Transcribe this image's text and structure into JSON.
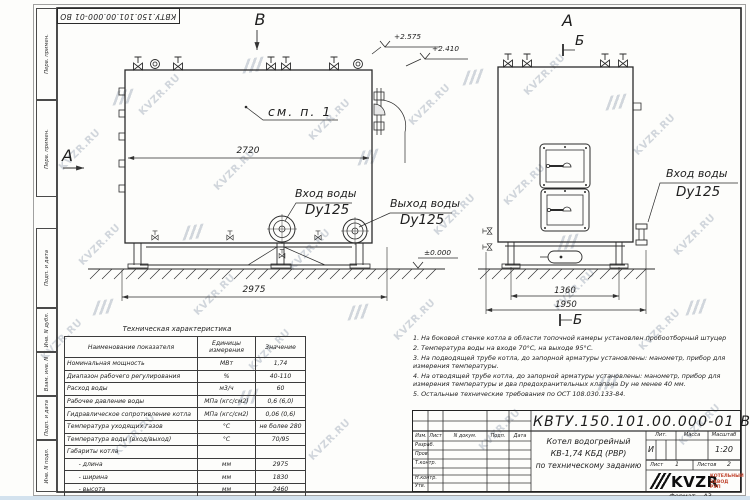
{
  "sheet": {
    "doc_number": "КВТУ.150.101.00.000-01 ВО",
    "format_label": "Формат",
    "format_value": "А3",
    "watermark": "KVZR.RU"
  },
  "margin_labels": [
    "Перв. примен.",
    "Перв. примен.",
    "Подп. и дата",
    "Инв. N дубл.",
    "Взам. инв. N",
    "Подп. и дата",
    "Инв. N подл."
  ],
  "side_view": {
    "view_arrow_top": "В",
    "view_arrow_left": "А",
    "callout": "см. п. 1",
    "elev_top": "+2.575",
    "elev_mid": "+2.410",
    "elev_zero": "±0.000",
    "dim_inner": "2720",
    "dim_outer": "2975",
    "inlet_title": "Вход воды",
    "inlet_dn": "Dy125",
    "outlet_title": "Выход воды",
    "outlet_dn": "Dy125"
  },
  "front_view": {
    "view_title": "А",
    "section_top": "Б",
    "section_bottom": "Б",
    "dim_inner": "1360",
    "dim_outer": "1950",
    "inlet_title": "Вход воды",
    "inlet_dn": "Dy125"
  },
  "spec_table": {
    "title": "Техническая характеристика",
    "headers": [
      "Наименование показателя",
      "Единицы измерения",
      "Значение"
    ],
    "rows": [
      [
        "Номинальная мощность",
        "МВт",
        "1,74"
      ],
      [
        "Диапазон рабочего регулирования",
        "%",
        "40-110"
      ],
      [
        "Расход воды",
        "м3/ч",
        "60"
      ],
      [
        "Рабочее давление воды",
        "МПа (кгс/см2)",
        "0,6 (6,0)"
      ],
      [
        "Гидравлическое сопротивление котла",
        "МПа (кгс/см2)",
        "0,06 (0,6)"
      ],
      [
        "Температура уходящих газов",
        "°С",
        "не более 280"
      ],
      [
        "Температура воды (вход/выход)",
        "°С",
        "70/95"
      ],
      [
        "Габариты котла",
        "",
        ""
      ],
      [
        "      - длина",
        "мм",
        "2975"
      ],
      [
        "      - ширина",
        "мм",
        "1830"
      ],
      [
        "      - высота",
        "мм",
        "2460"
      ]
    ]
  },
  "notes": [
    "1.  На боковой стенке котла в области топочной камеры установлен пробоотборный штуцер",
    "2.  Температура воды на входе 70°С, на выходе 95°С.",
    "3.  На подводящей трубе котла, до запорной арматуры установлены: манометр, прибор для измерения температуры.",
    "4.  На отводящей трубе котла, до запорной арматуры установлены: манометр, прибор для измерения температуры и два предохранительных клапана Dу не менее 40 мм.",
    "5.  Остальные технические требования по ОСТ 108.030.133-84."
  ],
  "title_block": {
    "doc_number": "КВТУ.150.101.00.000-01 ВО",
    "col_izm": "Изм.",
    "col_list": "Лист",
    "col_ndoc": "N докум.",
    "col_podp": "Подп.",
    "col_data": "Дата",
    "row_razrab": "Разраб.",
    "row_prov": "Пров.",
    "row_tkontr": "Т.контр.",
    "row_nkontr": "Н.контр.",
    "row_utv": "Утв.",
    "name_line1": "Котел водогрейный",
    "name_line2": "КВ-1,74 КБД (РВР)",
    "name_line3": "по техническому заданию",
    "lit_label": "Лит.",
    "mass_label": "Масса",
    "scale_label": "Масштаб",
    "lit_value": "И",
    "scale_value": "1:20",
    "sheet_label": "Лист",
    "sheet_value": "1",
    "sheets_label": "Листов",
    "sheets_value": "2",
    "logo_text": "KVZR",
    "logo_sub1": "КОТЕЛЬНЫЙ",
    "logo_sub2": "ЗАВОД РЭП"
  },
  "colors": {
    "line": "#2b2b2b",
    "accent_red": "#c0432c",
    "watermark": "#94a0b0"
  }
}
